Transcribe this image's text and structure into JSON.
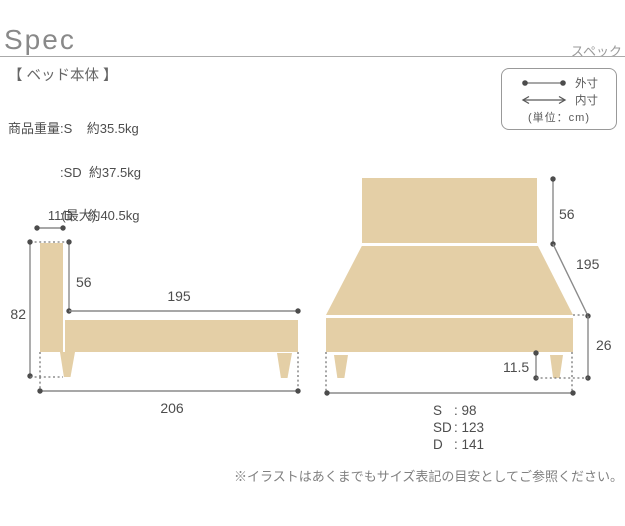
{
  "header": {
    "title": "Spec",
    "subtitle": "スペック"
  },
  "section_heading": "【 ベッド本体 】",
  "weights": {
    "label": "商品重量",
    "rows": [
      ":S    約35.5kg",
      ":SD  約37.5kg",
      ":D    約40.5kg"
    ]
  },
  "legend": {
    "outer_label": "外寸",
    "inner_label": "内寸",
    "unit": "(単位：cm)"
  },
  "colors": {
    "bed_fill": "#e4cfa6",
    "dimension_line": "#8a8a8a",
    "dimension_dot": "#4c4c4c"
  },
  "side_view": {
    "headboard_width": "11(最大)",
    "total_height": "82",
    "headboard_above_frame": "56",
    "inner_length": "195",
    "total_length": "206"
  },
  "front_view": {
    "headboard_height": "56",
    "length": "195",
    "base_height": "26",
    "leg_height": "11.5",
    "width_rows": [
      {
        "label": "S",
        "value": ": 98"
      },
      {
        "label": "SD",
        "value": ": 123"
      },
      {
        "label": "D",
        "value": ": 141"
      }
    ]
  },
  "footnote": "※イラストはあくまでもサイズ表記の目安としてご参照ください。"
}
